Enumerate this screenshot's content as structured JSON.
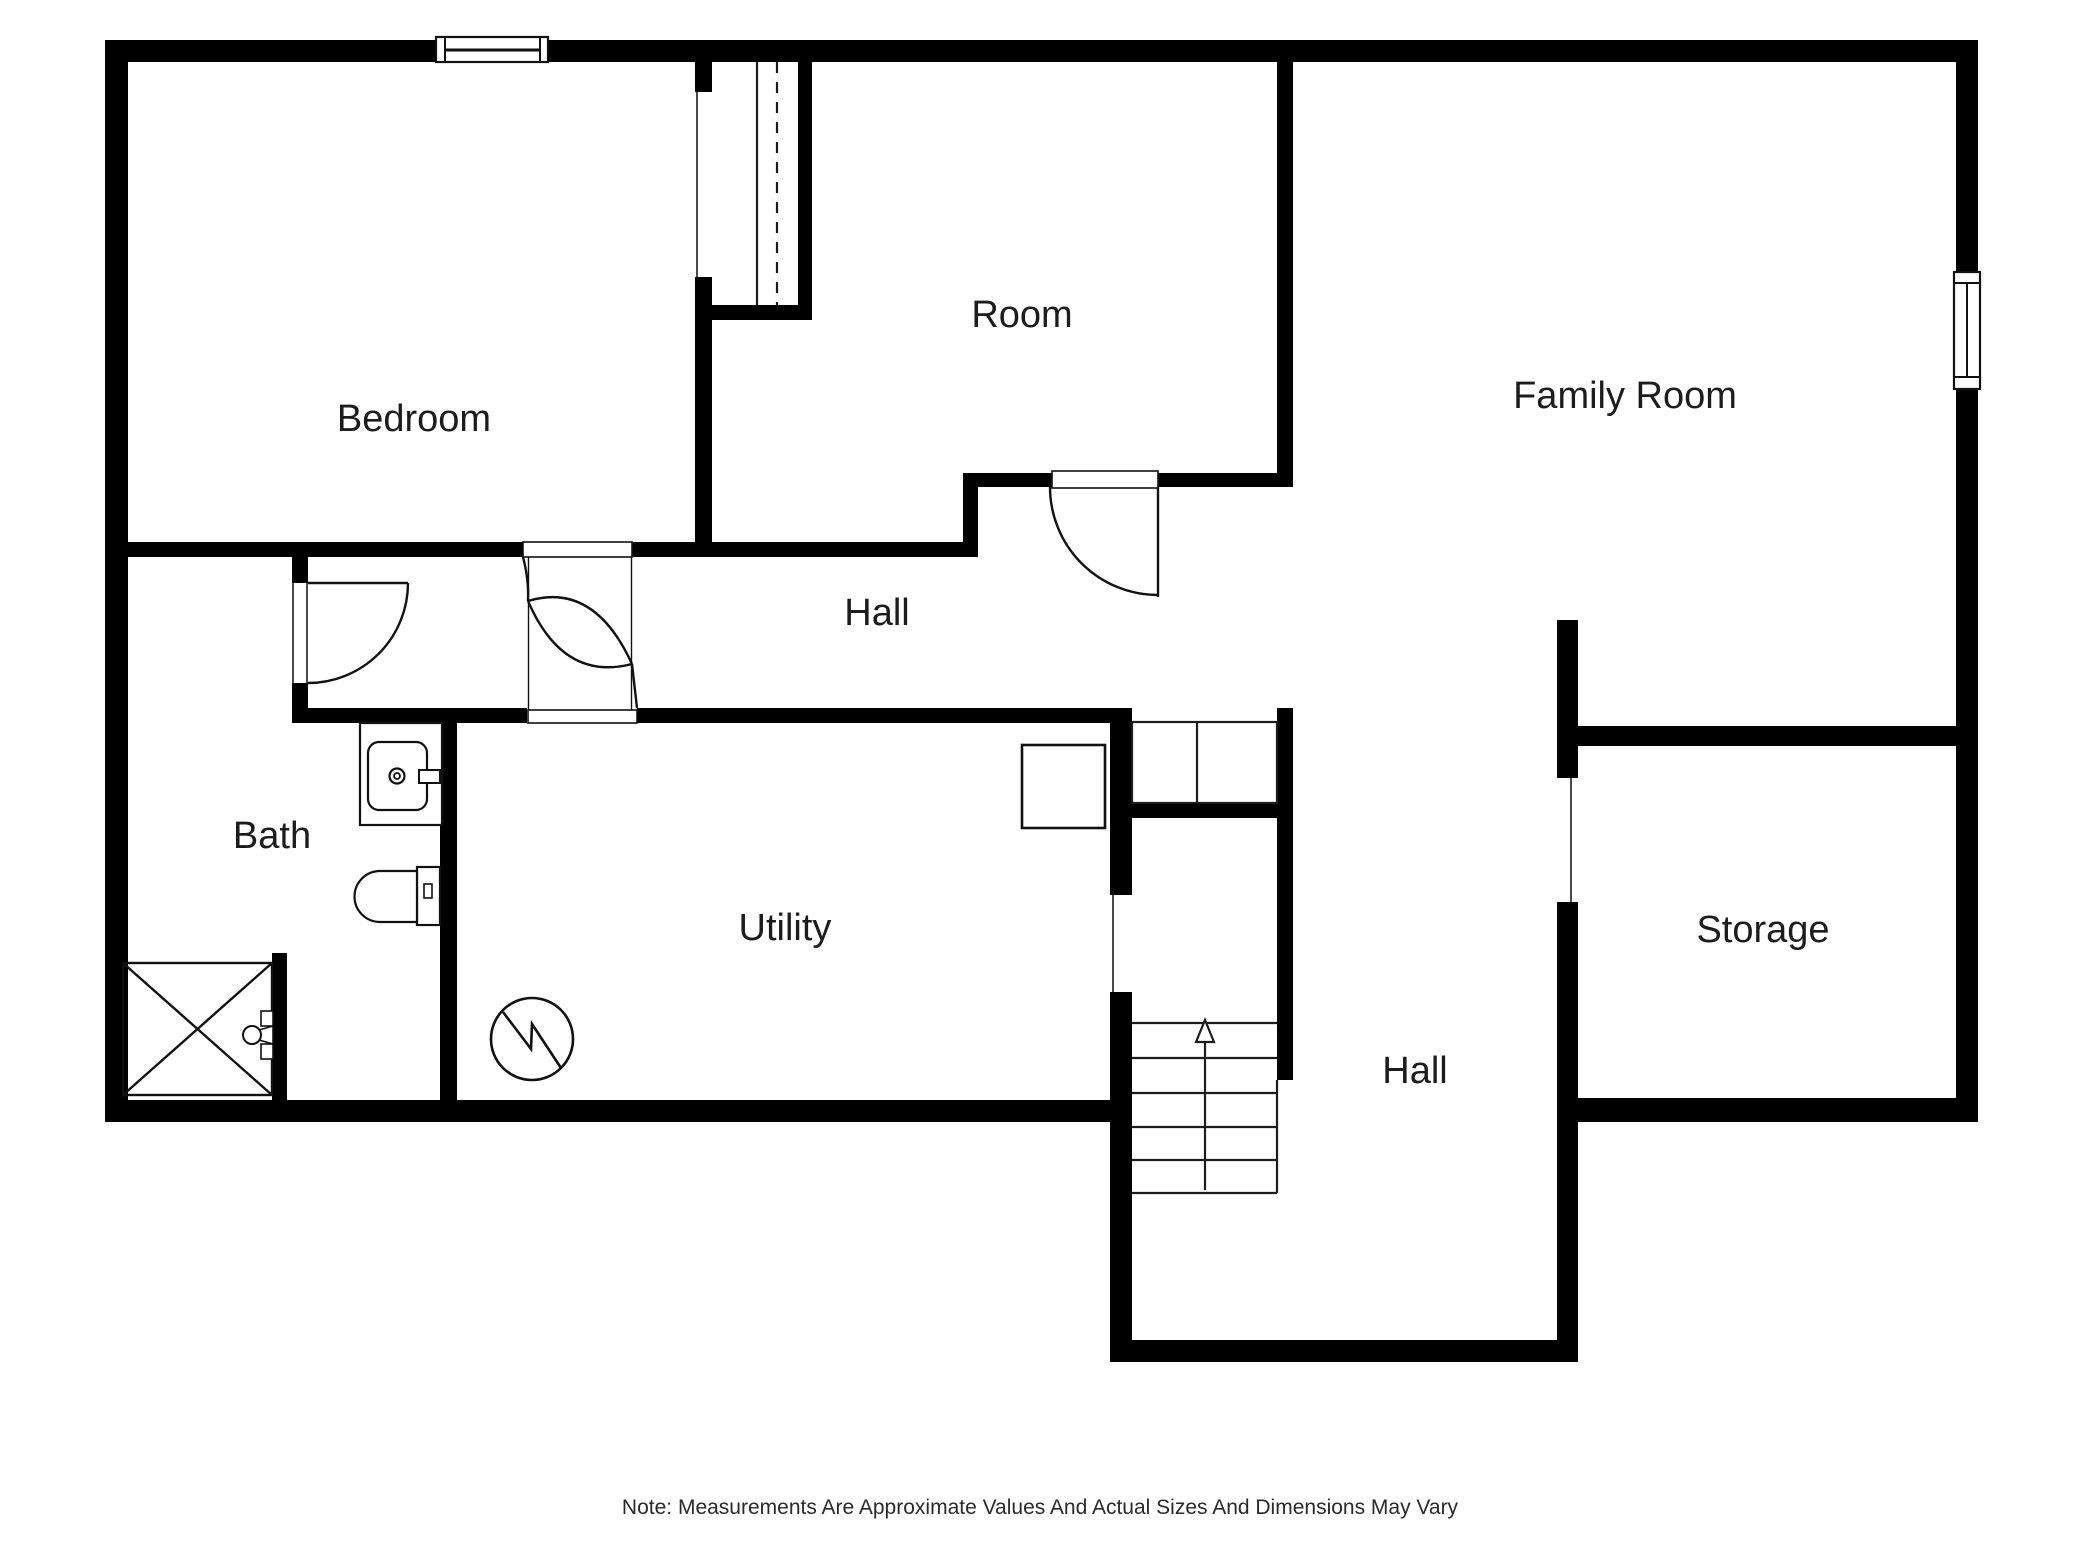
{
  "plan": {
    "title": "Basement floor plan",
    "colors": {
      "background": "#ffffff",
      "wall": "#000000",
      "line": "#1c1c1c",
      "text": "#1c1c1c"
    },
    "rooms": [
      {
        "id": "bedroom",
        "label": "Bedroom"
      },
      {
        "id": "room",
        "label": "Room"
      },
      {
        "id": "family-room",
        "label": "Family Room"
      },
      {
        "id": "hall-upper",
        "label": "Hall"
      },
      {
        "id": "bath",
        "label": "Bath"
      },
      {
        "id": "utility",
        "label": "Utility"
      },
      {
        "id": "storage",
        "label": "Storage"
      },
      {
        "id": "hall-lower",
        "label": "Hall"
      }
    ],
    "fixtures": [
      "window",
      "swing-door",
      "corridor-swing-door",
      "closet-shelf-lines",
      "sink-vanity",
      "toilet",
      "shower-pan",
      "shower-valve",
      "water-heater-circle",
      "appliance-square",
      "stairs-up-arrow",
      "stair-treads"
    ],
    "note": "Note: Measurements Are Approximate Values And Actual Sizes And Dimensions May Vary"
  }
}
